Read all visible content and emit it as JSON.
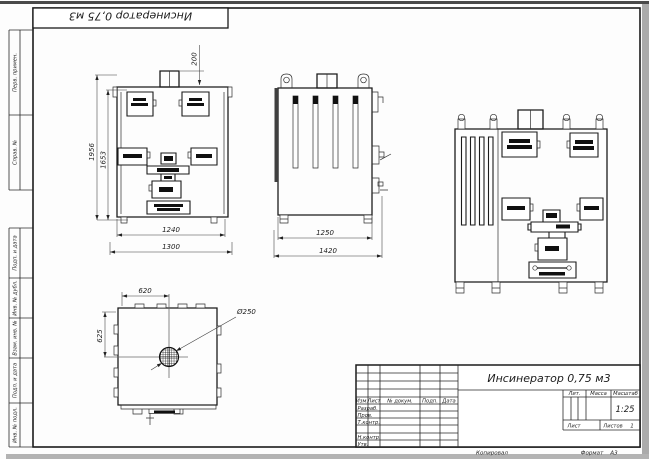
{
  "corner_stamp": "Инсинератор 0,75 м3",
  "frame_margin": {
    "perv_primen": "Перв. примен.",
    "sprav_no": "Справ. №",
    "podp_i_data_1": "Подп. и дата",
    "inv_no_dubl": "Инв. № дубл.",
    "vzam_inv_no": "Взам. инв. №",
    "podp_i_data_2": "Подп. и дата",
    "inv_no_podl": "Инв. № подл."
  },
  "title_block": {
    "title": "Инсинератор 0,75 м3",
    "izm": "Изм.",
    "list_col": "Лист",
    "n_docum": "№ докум.",
    "podp": "Подп.",
    "data": "Дата",
    "razrab": "Разраб.",
    "prov": "Пров.",
    "t_kontr": "Т.контр.",
    "n_kontr": "Н.контр.",
    "utv": "Утв.",
    "lit": "Лит.",
    "massa": "Масса",
    "masshtab": "Масштаб",
    "scale_value": "1:25",
    "list_label": "Лист",
    "listov_label": "Листов",
    "listov_value": "1",
    "kopiroval": "Копировал",
    "format_label": "Формат",
    "format_value": "А3"
  },
  "dims": {
    "front_height_overall": "1956",
    "front_height_inner": "1653",
    "front_width_inner": "1240",
    "front_width_overall": "1300",
    "chimney_height": "200",
    "side_depth_inner": "1250",
    "side_depth_overall": "1420",
    "top_center_x": "620",
    "top_center_y": "625",
    "flue_diameter": "Ø250"
  }
}
